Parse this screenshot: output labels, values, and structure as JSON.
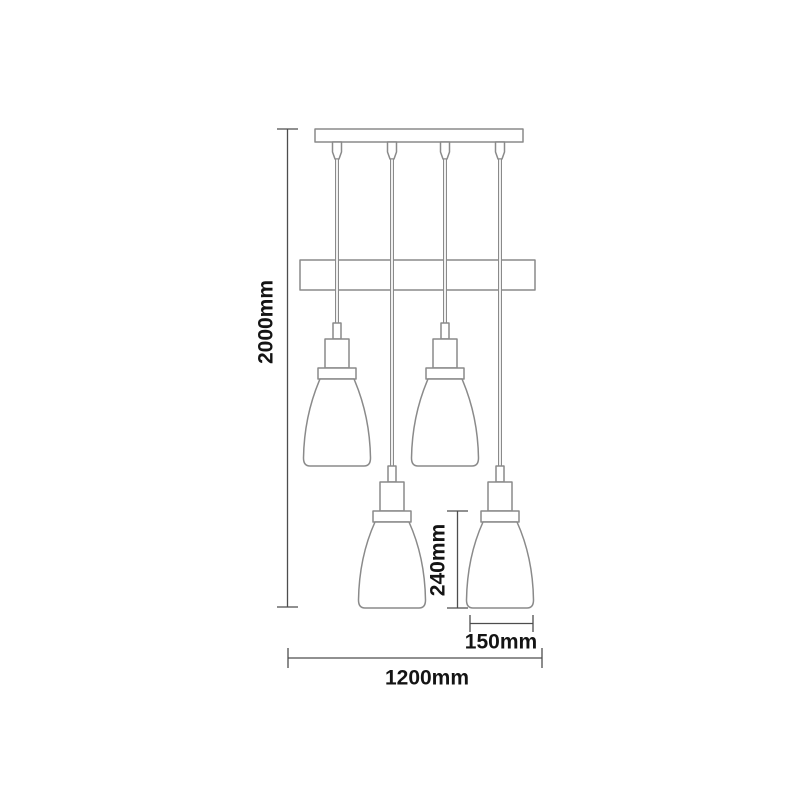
{
  "diagram": {
    "kind": "pendant-light-dimension-drawing",
    "dimensions": {
      "overall_height": "2000mm",
      "overall_width": "1200mm",
      "shade_height": "240mm",
      "shade_width": "150mm"
    },
    "colors": {
      "background": "#ffffff",
      "drawing_line": "#8a8a8a",
      "dimension_line": "#4d4d4d",
      "label_text": "#141414"
    }
  }
}
